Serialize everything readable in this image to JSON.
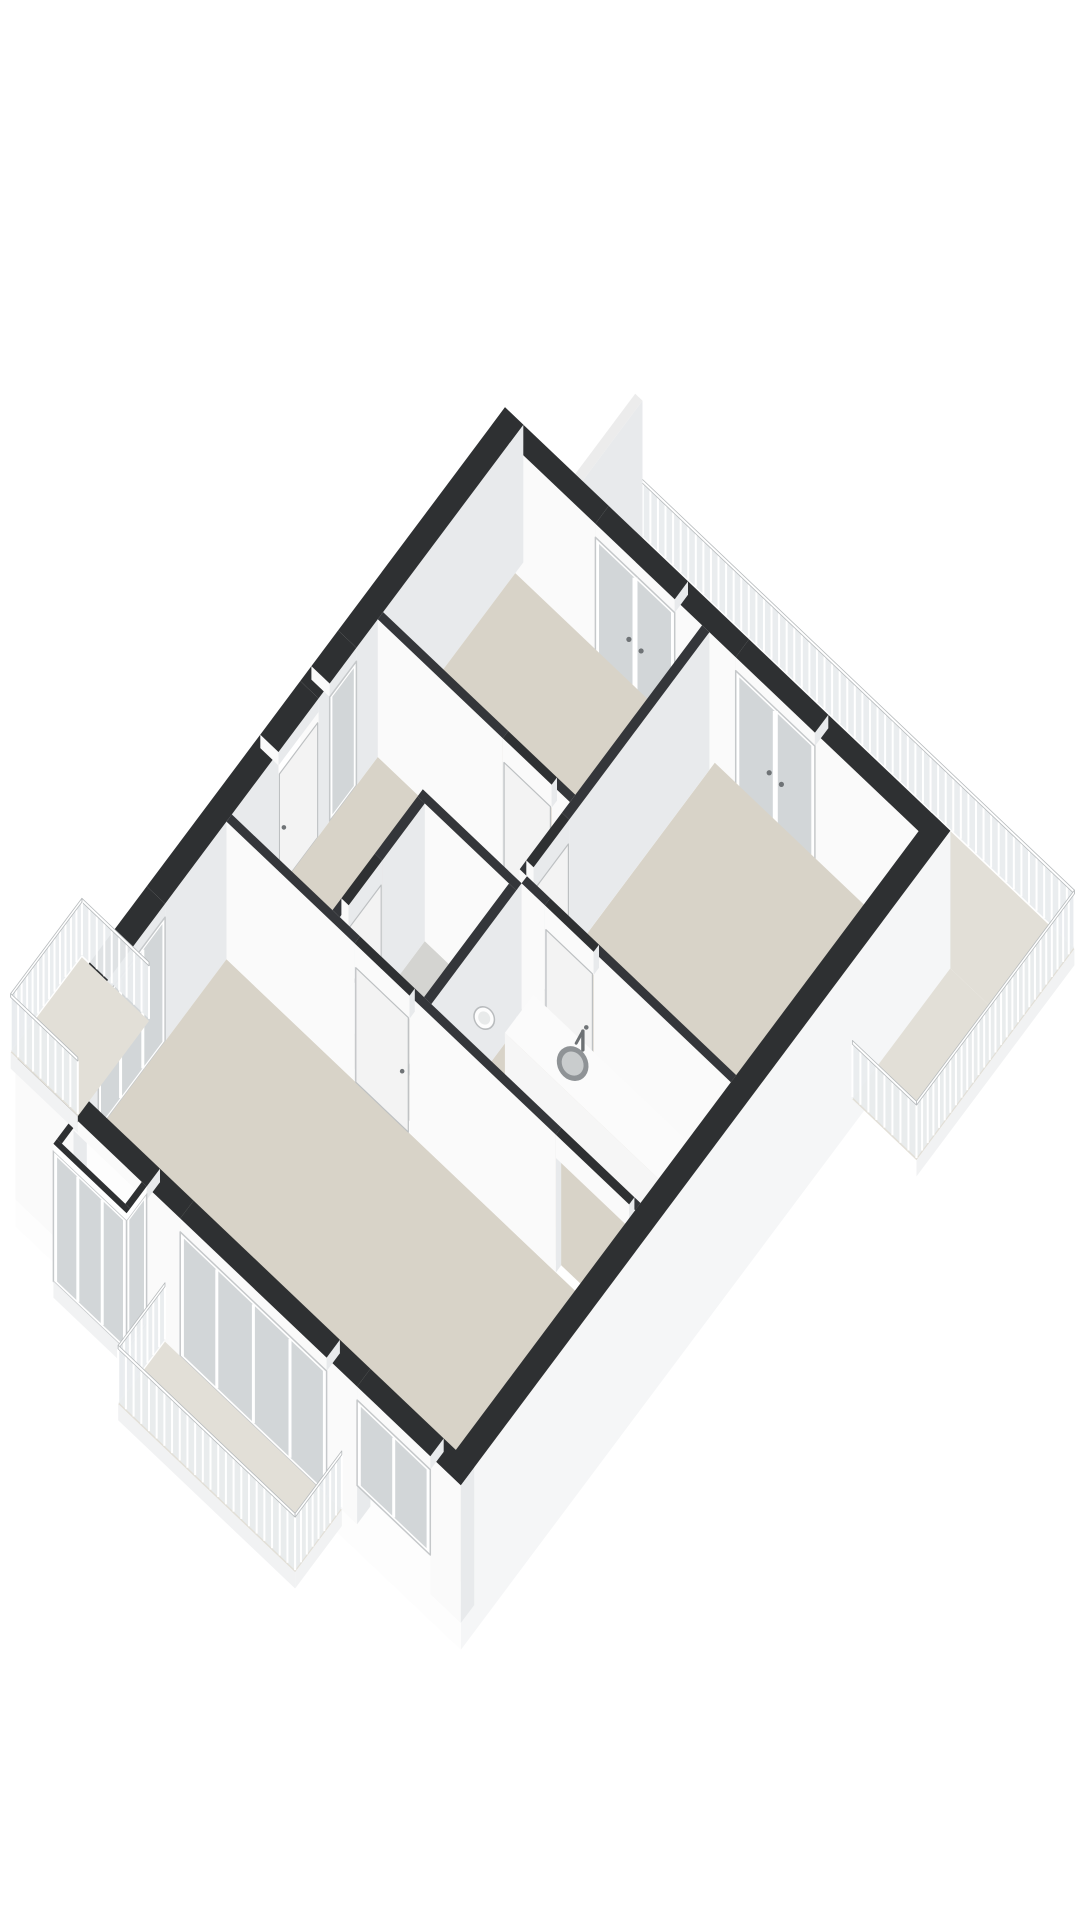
{
  "meta": {
    "type": "3d-floorplan-isometric-render",
    "background": "#ffffff"
  },
  "palette": {
    "wall_top": "#2e3032",
    "int_wall_top": "#34363a",
    "wall_face_sw": "#fafafa",
    "wall_face_se": "#e8eaec",
    "floor": "#d8d3c8",
    "floor_toilet": "#d4d4d1",
    "floor_balcony": "#e2dfd7",
    "skirt_se": "#f5f6f7",
    "skirt_sw": "#fdfdfd",
    "glass": "#d2d6d8",
    "frame": "#ffffff",
    "frame_stroke": "#c5c8ca",
    "door_leaf": "#f3f3f3",
    "door_stroke": "#bdc0c2",
    "handle": "#6f7376",
    "rail_band": "#e9ecee",
    "rail_slat": "#ffffff",
    "rail_edge": "#b7bbbd",
    "rail_top": "#ffffff",
    "fixture": "#fdfdfd",
    "fixture_side": "#eceeef",
    "fixture_stroke": "#b9bcbe",
    "sink_rim": "#8f9396",
    "sink_bowl": "#c9cccd",
    "metal": "#6d7174",
    "divider_top": "#ececec",
    "fascia": "#f1f2f3",
    "counter_top": "#fbfbfb",
    "counter_front": "#f6f6f6",
    "counter_side": "#e9ebec"
  },
  "projection": {
    "ox": 505,
    "oy": 545,
    "ux": 61,
    "uy": 58,
    "vx": -44.5,
    "vy": 59.5,
    "zz": 54,
    "wall_height": 2.55
  },
  "floorplan": {
    "floors": {
      "balcony-main": {
        "color": "floor_balcony",
        "poly": [
          [
            1.15,
            -1.35
          ],
          [
            8.35,
            -1.35
          ],
          [
            8.35,
            0
          ],
          [
            1.15,
            0
          ]
        ]
      },
      "balcony-wrap": {
        "color": "floor_balcony",
        "poly": [
          [
            7.3,
            0
          ],
          [
            8.35,
            0
          ],
          [
            8.35,
            2.2
          ],
          [
            7.3,
            2.2
          ]
        ]
      },
      "bedroom-1": {
        "color": "floor",
        "poly": [
          [
            0.3,
            0.18
          ],
          [
            3.45,
            0.18
          ],
          [
            3.45,
            3.15
          ],
          [
            0.3,
            3.15
          ]
        ]
      },
      "bedroom-2": {
        "color": "floor",
        "poly": [
          [
            3.57,
            0.18
          ],
          [
            7.0,
            0.18
          ],
          [
            7.0,
            4.4
          ],
          [
            3.57,
            4.4
          ]
        ]
      },
      "hallway": {
        "color": "floor",
        "poly": [
          [
            0.3,
            3.27
          ],
          [
            3.57,
            3.27
          ],
          [
            3.57,
            4.52
          ],
          [
            1.95,
            4.52
          ],
          [
            1.95,
            6.55
          ],
          [
            0.3,
            6.55
          ]
        ]
      },
      "toilet": {
        "color": "floor_toilet",
        "poly": [
          [
            2.07,
            4.64
          ],
          [
            3.45,
            4.64
          ],
          [
            3.45,
            6.55
          ],
          [
            2.07,
            6.55
          ]
        ]
      },
      "kitchen": {
        "color": "floor",
        "poly": [
          [
            3.57,
            4.52
          ],
          [
            7.0,
            4.52
          ],
          [
            7.0,
            6.55
          ],
          [
            3.57,
            6.55
          ]
        ]
      },
      "living-room": {
        "color": "floor",
        "poly": [
          [
            0.3,
            6.67
          ],
          [
            7.0,
            6.67
          ],
          [
            7.0,
            10.95
          ],
          [
            0.3,
            10.95
          ]
        ]
      },
      "balcony-left": {
        "color": "floor_balcony",
        "poly": [
          [
            -1.1,
            8.0
          ],
          [
            0,
            8.0
          ],
          [
            0,
            9.6
          ],
          [
            -1.1,
            9.6
          ]
        ]
      },
      "balcony-bottom": {
        "color": "floor_balcony",
        "poly": [
          [
            2.45,
            11
          ],
          [
            5.35,
            11
          ],
          [
            5.35,
            12.05
          ],
          [
            2.45,
            12.05
          ]
        ]
      },
      "bay-window-floor": {
        "color": "floor",
        "poly": [
          [
            0.95,
            11
          ],
          [
            2.15,
            11
          ],
          [
            2.15,
            11.45
          ],
          [
            0.95,
            11.45
          ]
        ]
      }
    },
    "ext_walls": {
      "wall-ne-left": [
        0,
        0,
        1.7,
        0.3
      ],
      "wall-ne-mid": [
        3.0,
        0,
        4.0,
        0.3
      ],
      "wall-ne-right": [
        5.3,
        0,
        7.3,
        0.3
      ],
      "wall-nw-top": [
        0,
        0,
        0.3,
        3.75
      ],
      "wall-nw-between": [
        0,
        4.35,
        0.3,
        4.6
      ],
      "wall-nw-mid": [
        0,
        5.5,
        0.3,
        8.05
      ],
      "wall-nw-bottom": [
        0,
        9.55,
        0.3,
        11
      ],
      "wall-sw-left": [
        0,
        10.7,
        0.95,
        11
      ],
      "wall-sw-midleft": [
        2.15,
        10.7,
        2.7,
        11
      ],
      "wall-sw-midright": [
        5.1,
        10.7,
        5.6,
        11
      ],
      "wall-sw-right": [
        6.8,
        10.7,
        7.3,
        11
      ]
    },
    "se_wall_top": [
      7.0,
      0,
      7.3,
      11
    ],
    "int_walls": {
      "wall-bed1-hall-left": [
        0.3,
        3.15,
        2.35,
        3.27
      ],
      "wall-bed1-hall-right": [
        3.15,
        3.15,
        3.45,
        3.27
      ],
      "wall-bed1-bed2": [
        3.45,
        0.3,
        3.57,
        3.45
      ],
      "wall-bed2-stub": [
        3.45,
        4.25,
        3.57,
        4.4
      ],
      "wall-bed2-kitchen-left": [
        3.57,
        4.4,
        3.95,
        4.52
      ],
      "wall-bed2-kitchen-right": [
        4.75,
        4.4,
        7.0,
        4.52
      ],
      "wall-toilet-top": [
        1.95,
        4.52,
        3.57,
        4.64
      ],
      "wall-toilet-right": [
        3.45,
        4.64,
        3.57,
        6.55
      ],
      "wall-toilet-left-top": [
        1.95,
        4.64,
        2.07,
        5.6
      ],
      "wall-toilet-left-bottom": [
        1.95,
        6.35,
        2.07,
        6.55
      ],
      "wall-living-top-left": [
        0.3,
        6.55,
        2.4,
        6.67
      ],
      "wall-living-top-mid": [
        3.3,
        6.55,
        5.7,
        6.67
      ],
      "wall-living-top-right": [
        6.9,
        6.55,
        7.0,
        6.67
      ]
    },
    "lintels": {
      "lintel-bed1-balcony": [
        1.7,
        0,
        3.0,
        0.3,
        2.3
      ],
      "lintel-bed2-balcony": [
        4.0,
        0,
        5.3,
        0.3,
        2.3
      ],
      "lintel-hall-window": [
        0,
        3.75,
        0.3,
        4.35,
        2.3
      ],
      "lintel-entrance": [
        0,
        4.6,
        0.3,
        5.5,
        2.3
      ],
      "lintel-band-left": [
        0,
        8.05,
        0.3,
        9.55,
        2.3
      ],
      "lintel-bay": [
        0.95,
        10.7,
        2.15,
        11,
        2.3
      ],
      "lintel-slider": [
        2.7,
        10.7,
        5.1,
        11,
        2.3
      ],
      "lintel-window-sw": [
        5.6,
        10.7,
        6.8,
        11,
        2.3
      ],
      "lintel-bed1-door": [
        2.35,
        3.15,
        3.15,
        3.27,
        2.12
      ],
      "lintel-bed2-door": [
        3.45,
        3.45,
        3.57,
        4.25,
        2.12
      ],
      "lintel-kitchen-door": [
        3.95,
        4.4,
        4.75,
        4.52,
        2.12
      ],
      "lintel-toilet-door": [
        1.95,
        5.6,
        2.07,
        6.35,
        2.12
      ],
      "lintel-living-door": [
        2.4,
        6.55,
        3.3,
        6.67,
        2.12
      ],
      "lintel-living-pass": [
        5.7,
        6.55,
        6.9,
        6.67,
        2.12
      ]
    },
    "glazings": {
      "bedroom-1-balcony-doors": {
        "plane": "y",
        "at": 0.3,
        "from": 1.7,
        "to": 3.0,
        "sill": 0,
        "head": 2.3,
        "panes": 2,
        "double_door": true
      },
      "bedroom-2-balcony-doors": {
        "plane": "y",
        "at": 0.3,
        "from": 4.0,
        "to": 5.3,
        "sill": 0,
        "head": 2.3,
        "panes": 2,
        "double_door": true
      },
      "hallway-window": {
        "plane": "x",
        "at": 0.3,
        "from": 3.75,
        "to": 4.35,
        "sill": 0,
        "head": 2.3,
        "panes": 1
      },
      "living-window-band-left": {
        "plane": "x",
        "at": 0.3,
        "from": 8.05,
        "to": 9.55,
        "sill": 0,
        "head": 2.3,
        "panes": 3
      },
      "living-slider-sw": {
        "plane": "y",
        "at": 11,
        "from": 2.7,
        "to": 5.1,
        "sill": 0,
        "head": 2.3,
        "panes": 4
      },
      "living-window-sw": {
        "plane": "y",
        "at": 11,
        "from": 5.6,
        "to": 6.8,
        "sill": 0.72,
        "head": 2.3,
        "panes": 2
      },
      "bay-front-glass": {
        "plane": "y",
        "at": 11.45,
        "from": 0.95,
        "to": 2.15,
        "sill": 0,
        "head": 2.42,
        "panes": 3
      },
      "bay-side-glass": {
        "plane": "x",
        "at": 2.15,
        "from": 11.0,
        "to": 11.45,
        "sill": 0,
        "head": 2.42,
        "panes": 1
      }
    },
    "doors": {
      "entrance-door": {
        "plane": "x",
        "at": 0.3,
        "from": 4.6,
        "to": 5.5,
        "height": 2.12
      },
      "bedroom-1-door": {
        "plane": "y",
        "at": 3.27,
        "from": 2.35,
        "to": 3.15,
        "height": 2.12
      },
      "bedroom-2-door": {
        "plane": "x",
        "at": 3.57,
        "from": 3.45,
        "to": 4.25,
        "height": 2.12
      },
      "kitchen-door": {
        "plane": "y",
        "at": 4.52,
        "from": 3.95,
        "to": 4.75,
        "height": 2.12
      },
      "toilet-door": {
        "plane": "x",
        "at": 2.07,
        "from": 5.6,
        "to": 6.35,
        "height": 2.12
      },
      "living-room-door": {
        "plane": "y",
        "at": 6.67,
        "from": 2.4,
        "to": 3.3,
        "height": 2.12
      }
    },
    "railings": {
      "balcony-main-railing-rear": [
        [
          1.15,
          -1.35
        ],
        [
          8.35,
          -1.35
        ]
      ],
      "balcony-main-railing-side": [
        [
          8.35,
          -1.35
        ],
        [
          8.35,
          2.2
        ],
        [
          7.3,
          2.2
        ]
      ],
      "balcony-left-railing": [
        [
          0,
          8.0
        ],
        [
          -1.1,
          8.0
        ],
        [
          -1.1,
          9.6
        ],
        [
          0,
          9.6
        ]
      ],
      "balcony-bottom-railing": [
        [
          2.45,
          11
        ],
        [
          2.45,
          12.05
        ],
        [
          5.35,
          12.05
        ],
        [
          5.35,
          11
        ]
      ]
    },
    "divider": {
      "rect": [
        1.15,
        -1.35,
        1.27,
        0
      ]
    },
    "skirts": {
      "skirt-se": {
        "plane": "x",
        "at": 7.3,
        "from": 0,
        "to": 11,
        "z0": -0.5,
        "z1": 2.55,
        "color": "skirt_se"
      },
      "skirt-sw": {
        "plane": "y",
        "at": 11,
        "from": 0,
        "to": 7.3,
        "z0": -0.5,
        "z1": 2.55,
        "color": "skirt_sw"
      }
    },
    "fascias": {
      "fascia-wrap": {
        "plane": "x",
        "at": 8.35,
        "from": -1.35,
        "to": 2.2,
        "z0": -0.3,
        "z1": 0
      },
      "fascia-bottom-front": {
        "plane": "y",
        "at": 12.05,
        "from": 2.45,
        "to": 5.35,
        "z0": -0.3,
        "z1": 0
      },
      "fascia-bottom-right": {
        "plane": "x",
        "at": 5.35,
        "from": 11,
        "to": 12.05,
        "z0": -0.3,
        "z1": 0
      },
      "fascia-left-side": {
        "plane": "y",
        "at": 9.6,
        "from": -1.1,
        "to": 0,
        "z0": -0.3,
        "z1": 0
      },
      "fascia-bay-front": {
        "plane": "y",
        "at": 11.45,
        "from": 0.95,
        "to": 2.15,
        "z0": -0.3,
        "z1": 0
      },
      "fascia-bay-side": {
        "plane": "x",
        "at": 2.15,
        "from": 11,
        "to": 11.45,
        "z0": -0.3,
        "z1": 0
      }
    },
    "bay": {
      "tops": [
        [
          0.95,
          11.37,
          2.15,
          11.45
        ],
        [
          0.95,
          11,
          1.03,
          11.37
        ],
        [
          2.07,
          11,
          2.15,
          11.37
        ]
      ],
      "lintel_faces": [
        {
          "plane": "y",
          "at": 11.45,
          "from": 0.95,
          "to": 2.15,
          "z0": 2.42,
          "z1": 2.55
        },
        {
          "plane": "x",
          "at": 2.15,
          "from": 11,
          "to": 11.45,
          "z0": 2.42,
          "z1": 2.55
        }
      ]
    },
    "fixtures": {
      "kitchen-counter": {
        "rect": [
          3.85,
          4.64,
          6.75,
          5.28
        ],
        "height": 0.92
      },
      "kitchen-sink": {
        "center": [
          4.72,
          4.95
        ],
        "radius": 0.21,
        "inner_radius": 0.145
      },
      "kitchen-faucet": {
        "base": [
          4.72,
          4.72
        ],
        "height": 0.35
      },
      "toilet-cistern": {
        "rect": [
          3.2,
          5.7,
          3.45,
          6.16
        ],
        "height": 0.78
      },
      "toilet-buttons": [
        [
          3.3,
          5.85
        ],
        [
          3.3,
          6.01
        ]
      ],
      "toilet-bowl": {
        "center": [
          3.0,
          5.93
        ],
        "radius": 0.2,
        "inner_radius": 0.12
      },
      "toilet-basin": {
        "center": [
          3.19,
          4.84
        ],
        "radius": 0.135,
        "inner_radius": 0.08
      }
    }
  }
}
